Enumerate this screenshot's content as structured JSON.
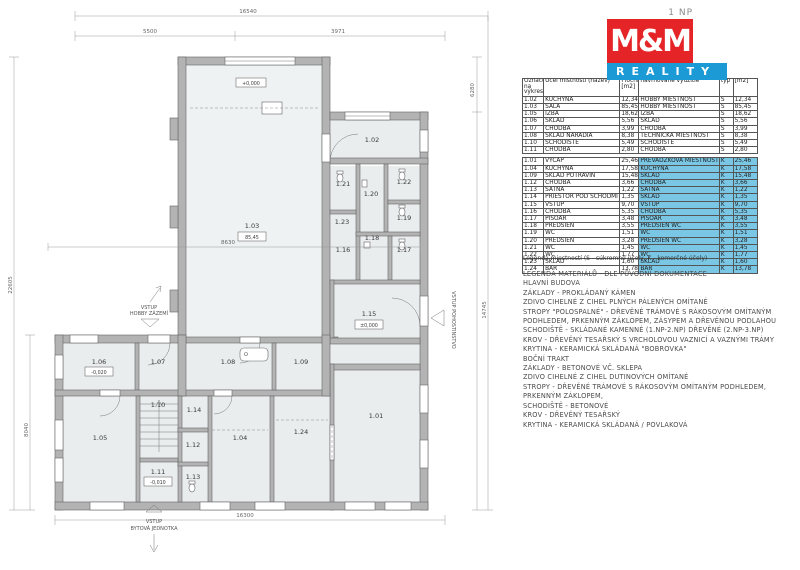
{
  "plan": {
    "room_labels": [
      "1.01",
      "1.02",
      "1.03",
      "1.04",
      "1.05",
      "1.06",
      "1.07",
      "1.08",
      "1.09",
      "1.10",
      "1.11",
      "1.12",
      "1.13",
      "1.14",
      "1.15",
      "1.16",
      "1.17",
      "1.18",
      "1.19",
      "1.20",
      "1.21",
      "1.22",
      "1.23",
      "1.24"
    ],
    "boxes": {
      "hall_top": "+0,000",
      "hall_area": "85,45",
      "r106": "-0,020",
      "r115": "±0,000",
      "r111": "-0,010"
    },
    "dims": {
      "top_total": "16540",
      "top_left": "5500",
      "top_right": "3971",
      "right_upper": "6280",
      "right_lower": "14745",
      "left_outer": "22605",
      "left_inner": "8040",
      "bottom": "16300",
      "hall": "8630"
    },
    "entrances": {
      "hobby_line1": "VSTUP",
      "hobby_line2": "HOBBY ZÁZEMÍ",
      "flat_line1": "VSTUP",
      "flat_line2": "BYTOVÁ JEDNOTKA",
      "pub": "VSTUP POHOSTINSTVO"
    }
  },
  "sidebar": {
    "floor_label": "1 NP",
    "logo": {
      "mm": "M&M",
      "reality": "REALITY"
    },
    "colors": {
      "red": "#e52428",
      "blue": "#1b9ad6",
      "highlight": "#79c7e5"
    },
    "table": {
      "header": [
        "Označení na výkresu",
        "Účel místnosti (název)",
        "Plocha [m2]",
        "navrhované využitie",
        "typ",
        "[m2]"
      ],
      "section1": [
        [
          "1.02",
          "KUCHYŇA",
          "12,34",
          "HOBBY MIESTNOSŤ",
          "S",
          "12,34"
        ],
        [
          "1.03",
          "SÁLA",
          "85,45",
          "HOBBY MIESTNOSŤ",
          "S",
          "85,45"
        ],
        [
          "1.05",
          "IZBA",
          "18,62",
          "IZBA",
          "S",
          "18,62"
        ],
        [
          "1.06",
          "SKLAD",
          "5,56",
          "SKLAD",
          "S",
          "5,56"
        ],
        [
          "1.07",
          "CHODBA",
          "3,99",
          "CHODBA",
          "S",
          "3,99"
        ],
        [
          "1.08",
          "SKLAD NÁRADIA",
          "8,38",
          "TECHNICKÁ MIESTNOSŤ",
          "S",
          "8,38"
        ],
        [
          "1.10",
          "SCHODIŠTĚ",
          "5,49",
          "SCHODIŠTĚ",
          "S",
          "5,49"
        ],
        [
          "1.11",
          "CHODBA",
          "2,80",
          "CHODBA",
          "S",
          "2,80"
        ]
      ],
      "section2": [
        [
          "1.01",
          "VÝČAP",
          "25,46",
          "PREVÁDZKOVÁ MIESTNOSŤ",
          "K",
          "25,46"
        ],
        [
          "1.04",
          "KUCHYŇA",
          "17,58",
          "KUCHYŇA",
          "K",
          "17,58"
        ],
        [
          "1.09",
          "SKLAD POTRAVÍN",
          "15,48",
          "SKLAD",
          "K",
          "15,48"
        ],
        [
          "1.12",
          "CHODBA",
          "3,66",
          "CHODBA",
          "K",
          "3,66"
        ],
        [
          "1.13",
          "ŠATŇA",
          "1,22",
          "ŠATŇA",
          "K",
          "1,22"
        ],
        [
          "1.14",
          "PRIESTOR POD SCHODMI",
          "1,35",
          "SKLAD",
          "K",
          "1,35"
        ],
        [
          "1.15",
          "VSTUP",
          "9,70",
          "VSTUP",
          "K",
          "9,70"
        ],
        [
          "1.16",
          "CHODBA",
          "5,35",
          "CHODBA",
          "K",
          "5,35"
        ],
        [
          "1.17",
          "PISOÁR",
          "3,48",
          "PISOÁR",
          "K",
          "3,48"
        ],
        [
          "1.18",
          "PREDSIEŇ",
          "3,55",
          "PREDSIEŇ WC",
          "K",
          "3,55"
        ],
        [
          "1.19",
          "WC",
          "1,51",
          "WC",
          "K",
          "1,51"
        ],
        [
          "1.20",
          "PREDSIEŇ",
          "3,28",
          "PREDSIEŇ WC",
          "K",
          "3,28"
        ],
        [
          "1.21",
          "WC",
          "1,45",
          "WC",
          "K",
          "1,45"
        ],
        [
          "1.22",
          "WC",
          "1,77",
          "WC",
          "K",
          "1,77"
        ],
        [
          "1.23",
          "SKLAD",
          "1,60",
          "SKLAD",
          "K",
          "1,60"
        ],
        [
          "1.24",
          "BAR",
          "13,78",
          "BAR",
          "K",
          "13,78"
        ]
      ]
    },
    "note": "Legenda miestností (S - súkromné účely, K - komerčné účely)",
    "legend_lines": [
      "LEGENDA MATERIÁLŮ - DLE PŮVODNÍ DOKUMENTACE",
      "HLAVNÍ BUDOVA",
      "ZÁKLADY - PROKLÁDANÝ KÁMEN",
      "ZDIVO CIHELNÉ Z CIHEL PLNÝCH PÁLENÝCH OMÍTANÉ",
      "STROPY \"POLOSPALNÉ\" - DŘEVĚNÉ TRÁMOVÉ S RÁKOSOVÝM OMÍTANÝM",
      "PODHLEDEM, PRKENNÝM ZÁKLOPEM, ZÁSYPEM A DŘEVĚNOU PODLAHOU",
      "SCHODIŠTĚ - SKLÁDANÉ KAMENNÉ (1.NP-2.NP) DŘEVĚNÉ (2.NP-3.NP)",
      "KROV - DŘEVĚNÝ TESAŘSKÝ S VRCHOLOVOU VAZNICÍ A VAZNÝMI TRÁMY",
      "KRYTINA - KERAMICKÁ SKLÁDANÁ \"BOBROVKA\"",
      "BOČNÍ TRAKT",
      "ZÁKLADY - BETONOVÉ VČ. SKLEPA",
      "ZDIVO CIHELNÉ Z CIHEL DUTINOVÝCH OMÍTANÉ",
      "STROPY - DŘEVĚNÉ TRÁMOVÉ S RÁKOSOVÝM OMÍTANÝM PODHLEDEM,",
      "PRKENNÝM ZÁKLOPEM,",
      "SCHODIŠTĚ - BETONOVÉ",
      "KROV - DŘEVĚNÝ TESAŘSKÝ",
      "KRYTINA - KERAMICKÁ SKLÁDANÁ / POVLAKOVÁ"
    ]
  }
}
